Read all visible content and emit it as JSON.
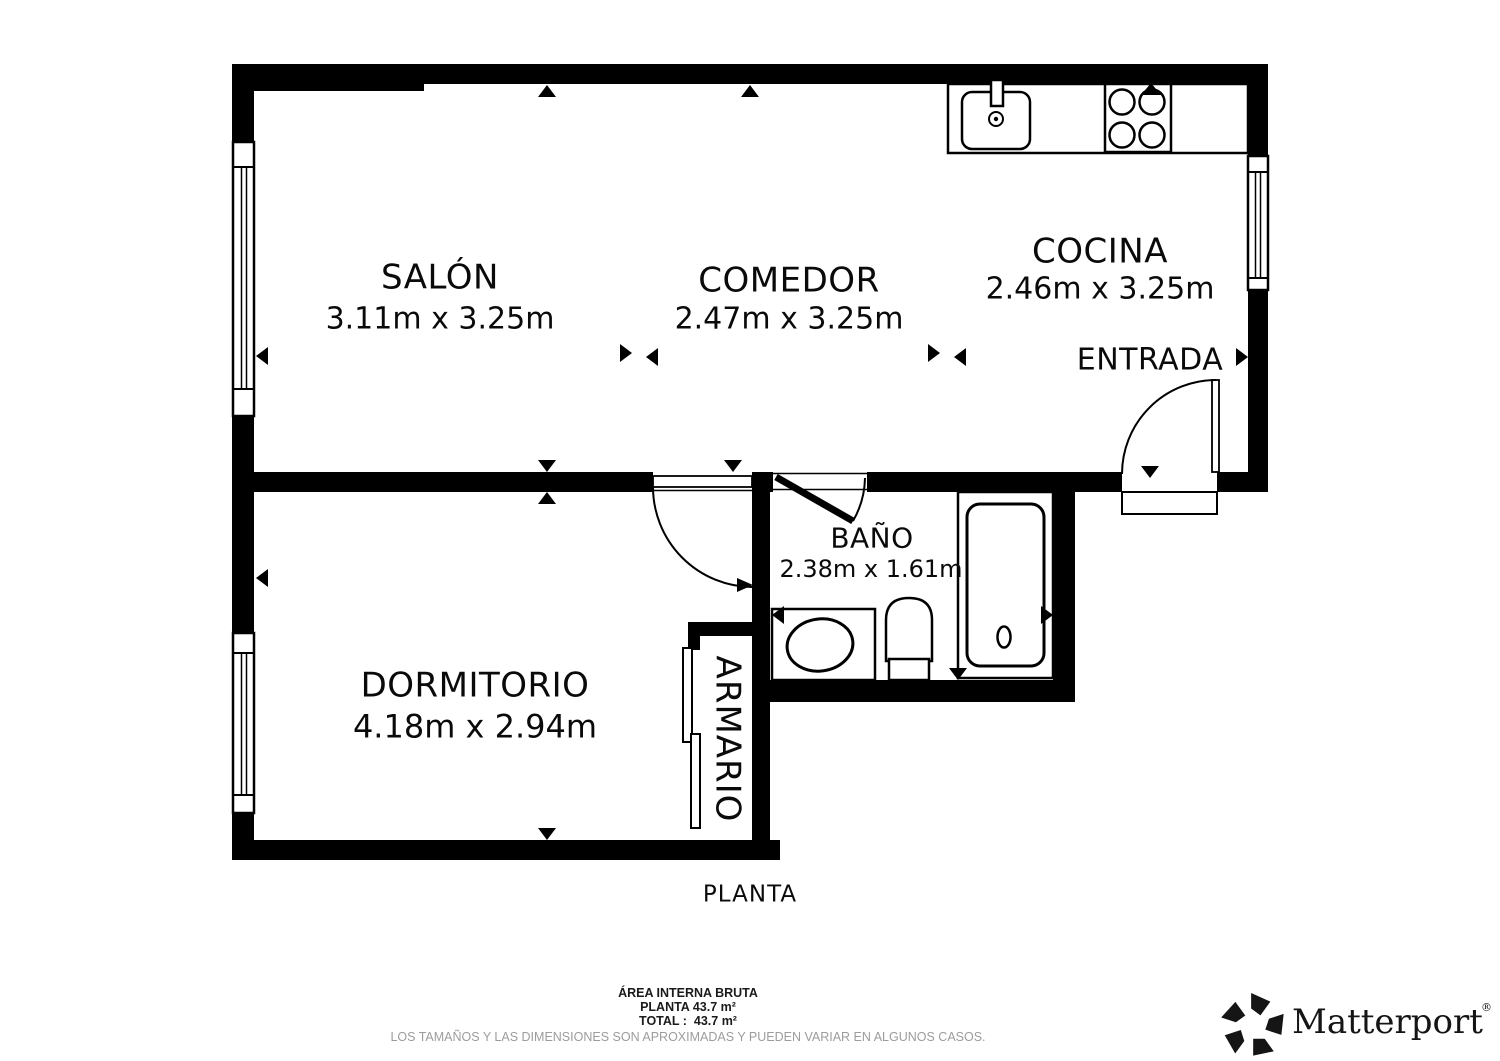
{
  "plan": {
    "floor_label": "PLANTA",
    "rooms": [
      {
        "name": "SALÓN",
        "dims": "3.11m x 3.25m"
      },
      {
        "name": "COMEDOR",
        "dims": "2.47m x 3.25m"
      },
      {
        "name": "COCINA",
        "dims": "2.46m x 3.25m"
      },
      {
        "name": "ENTRADA",
        "dims": ""
      },
      {
        "name": "BAÑO",
        "dims": "2.38m x 1.61m"
      },
      {
        "name": "DORMITORIO",
        "dims": "4.18m x 2.94m"
      },
      {
        "name": "ARMARIO",
        "dims": ""
      }
    ]
  },
  "footer": {
    "area_title": "ÁREA INTERNA BRUTA",
    "area_line1": "PLANTA 43.7 m²",
    "area_line2": "TOTAL :  43.7 m²",
    "disclaimer": "LOS TAMAÑOS Y LAS DIMENSIONES SON APROXIMADAS Y PUEDEN VARIAR EN ALGUNOS CASOS.",
    "brand": "Matterport",
    "brand_mark": "®"
  },
  "colors": {
    "wall": "#000000",
    "background": "#ffffff",
    "label": "#0a0a0a",
    "disclaimer_gray": "#9c9c9c",
    "brand_ink": "#151515"
  }
}
